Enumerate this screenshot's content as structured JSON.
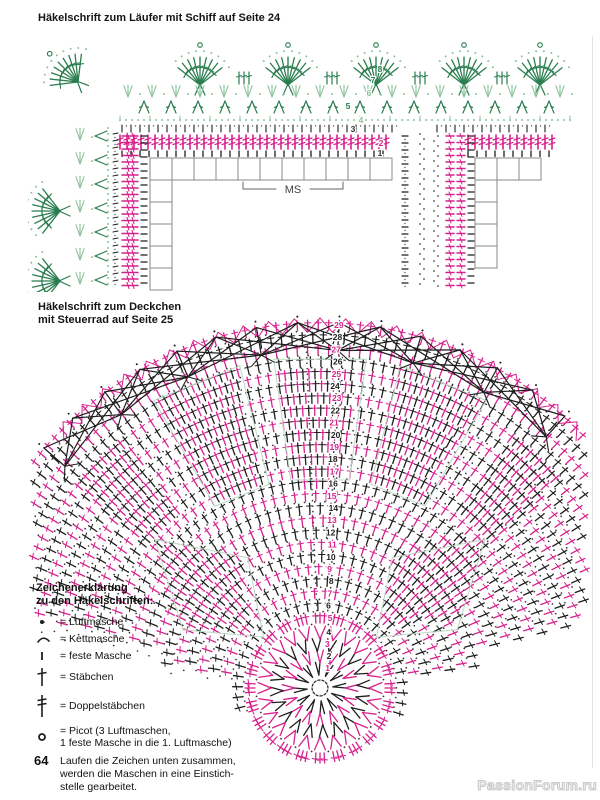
{
  "page": {
    "title_runner": "Häkelschrift zum Läufer mit Schiff auf Seite 24",
    "title_doily_line1": "Häkelschrift zum Deckchen",
    "title_doily_line2": "mit Steuerrad auf Seite 25",
    "ms_label": "MS",
    "page_number": "64",
    "watermark": "PassionForum.ru"
  },
  "runner_chart": {
    "row_numbers": [
      "8",
      "7",
      "6",
      "5",
      "4",
      "3",
      "2",
      "1"
    ]
  },
  "doily_chart": {
    "row_numbers": [
      "1",
      "2",
      "3",
      "4",
      "5",
      "6",
      "7",
      "8",
      "9",
      "10",
      "11",
      "12",
      "13",
      "14",
      "15",
      "16",
      "17",
      "18",
      "19",
      "20",
      "21",
      "22",
      "23",
      "24",
      "25",
      "26",
      "27",
      "28",
      "29"
    ]
  },
  "legend": {
    "heading_line1": "Zeichenerklärung",
    "heading_line2": "zu den Häkelschriften:",
    "items": [
      {
        "symbol": "chain-stitch",
        "label": "= Luftmasche"
      },
      {
        "symbol": "slip-stitch",
        "label": "= Kettmasche"
      },
      {
        "symbol": "single-crochet",
        "label": "= feste Masche"
      },
      {
        "symbol": "double-crochet",
        "label": "= Stäbchen"
      },
      {
        "symbol": "treble-crochet",
        "label": "= Doppelstäbchen"
      },
      {
        "symbol": "picot",
        "label": "= Picot (3 Luftmaschen,",
        "label2": "1 feste Masche in die 1. Luftmasche)"
      }
    ],
    "note_line1": "Laufen die Zeichen unten zusammen,",
    "note_line2": "werden die Maschen in eine Einstich-",
    "note_line3": "stelle gearbeitet."
  },
  "colors": {
    "magenta": "#d6218c",
    "dark_green": "#2a7d4f",
    "light_green": "#8cc39b",
    "black": "#1e1e1e",
    "grid_gray": "#8a8a8a",
    "outline_green": "#bcd9c6"
  }
}
